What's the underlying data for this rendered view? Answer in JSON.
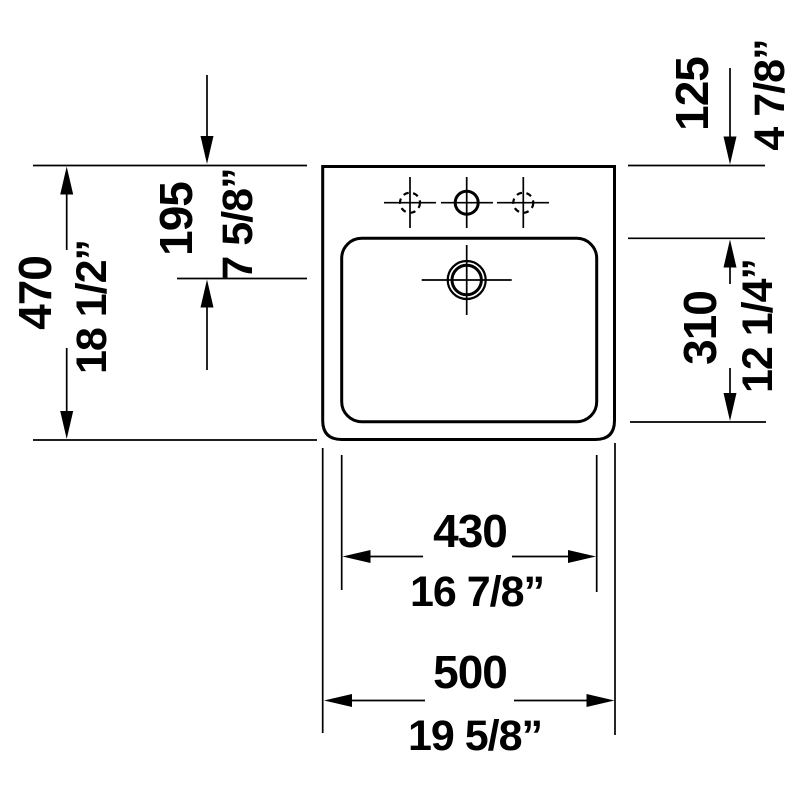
{
  "canvas": {
    "background": "#ffffff",
    "ink": "#000000"
  },
  "drawing": {
    "name": "washbasin technical drawing - top view",
    "features": {
      "faucet_holes": 3,
      "overflow_hole": 1
    }
  },
  "dimensions": {
    "overall_depth": {
      "mm": "470",
      "inches": "18 1/2”"
    },
    "faucet_line": {
      "mm": "195",
      "inches": "7 5/8”"
    },
    "rear_ledge": {
      "mm": "125",
      "inches": "4 7/8”"
    },
    "basin_depth": {
      "mm": "310",
      "inches": "12 1/4”"
    },
    "basin_width": {
      "mm": "430",
      "inches": "16 7/8”"
    },
    "overall_width": {
      "mm": "500",
      "inches": "19 5/8”"
    }
  }
}
